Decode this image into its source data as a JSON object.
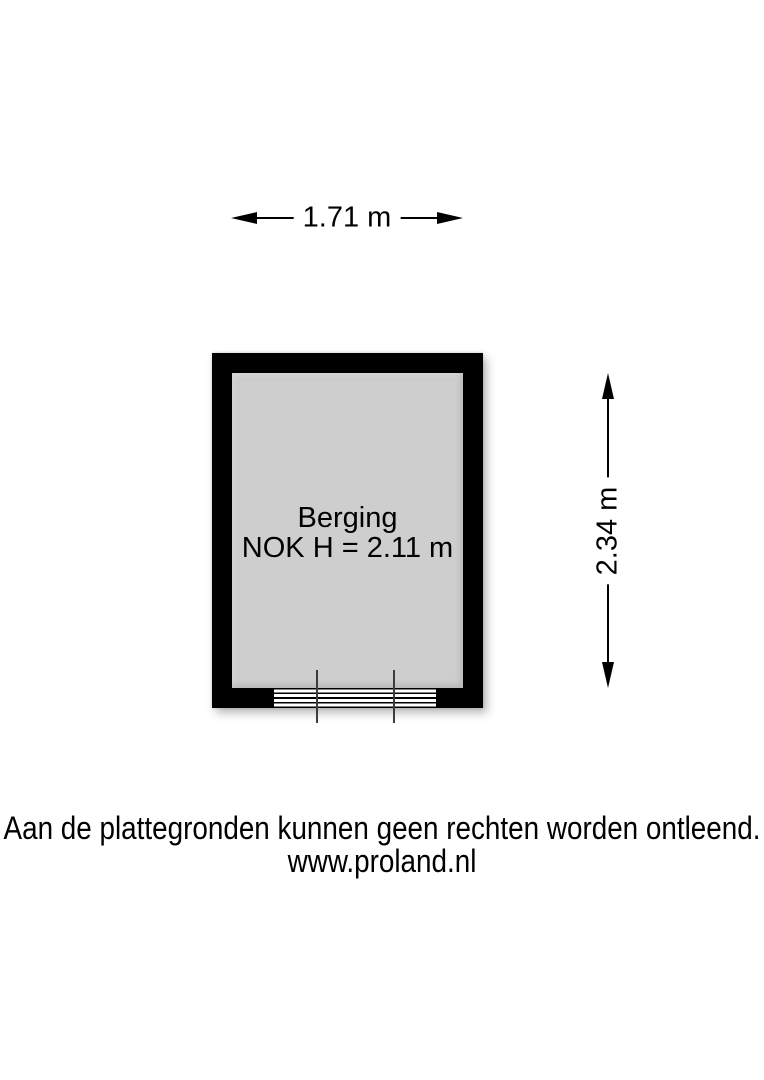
{
  "floorplan": {
    "dimensions": {
      "width_label": "1.71 m",
      "height_label": "2.34 m"
    },
    "room": {
      "name": "Berging",
      "ridge_height_label": "NOK H = 2.11 m"
    },
    "colors": {
      "wall": "#000000",
      "floor": "#cecece",
      "background": "#ffffff",
      "door_frame_line": "#3c3c3c"
    }
  },
  "footer": {
    "disclaimer": "Aan de plattegronden kunnen geen rechten worden ontleend.",
    "website": "www.proland.nl"
  }
}
